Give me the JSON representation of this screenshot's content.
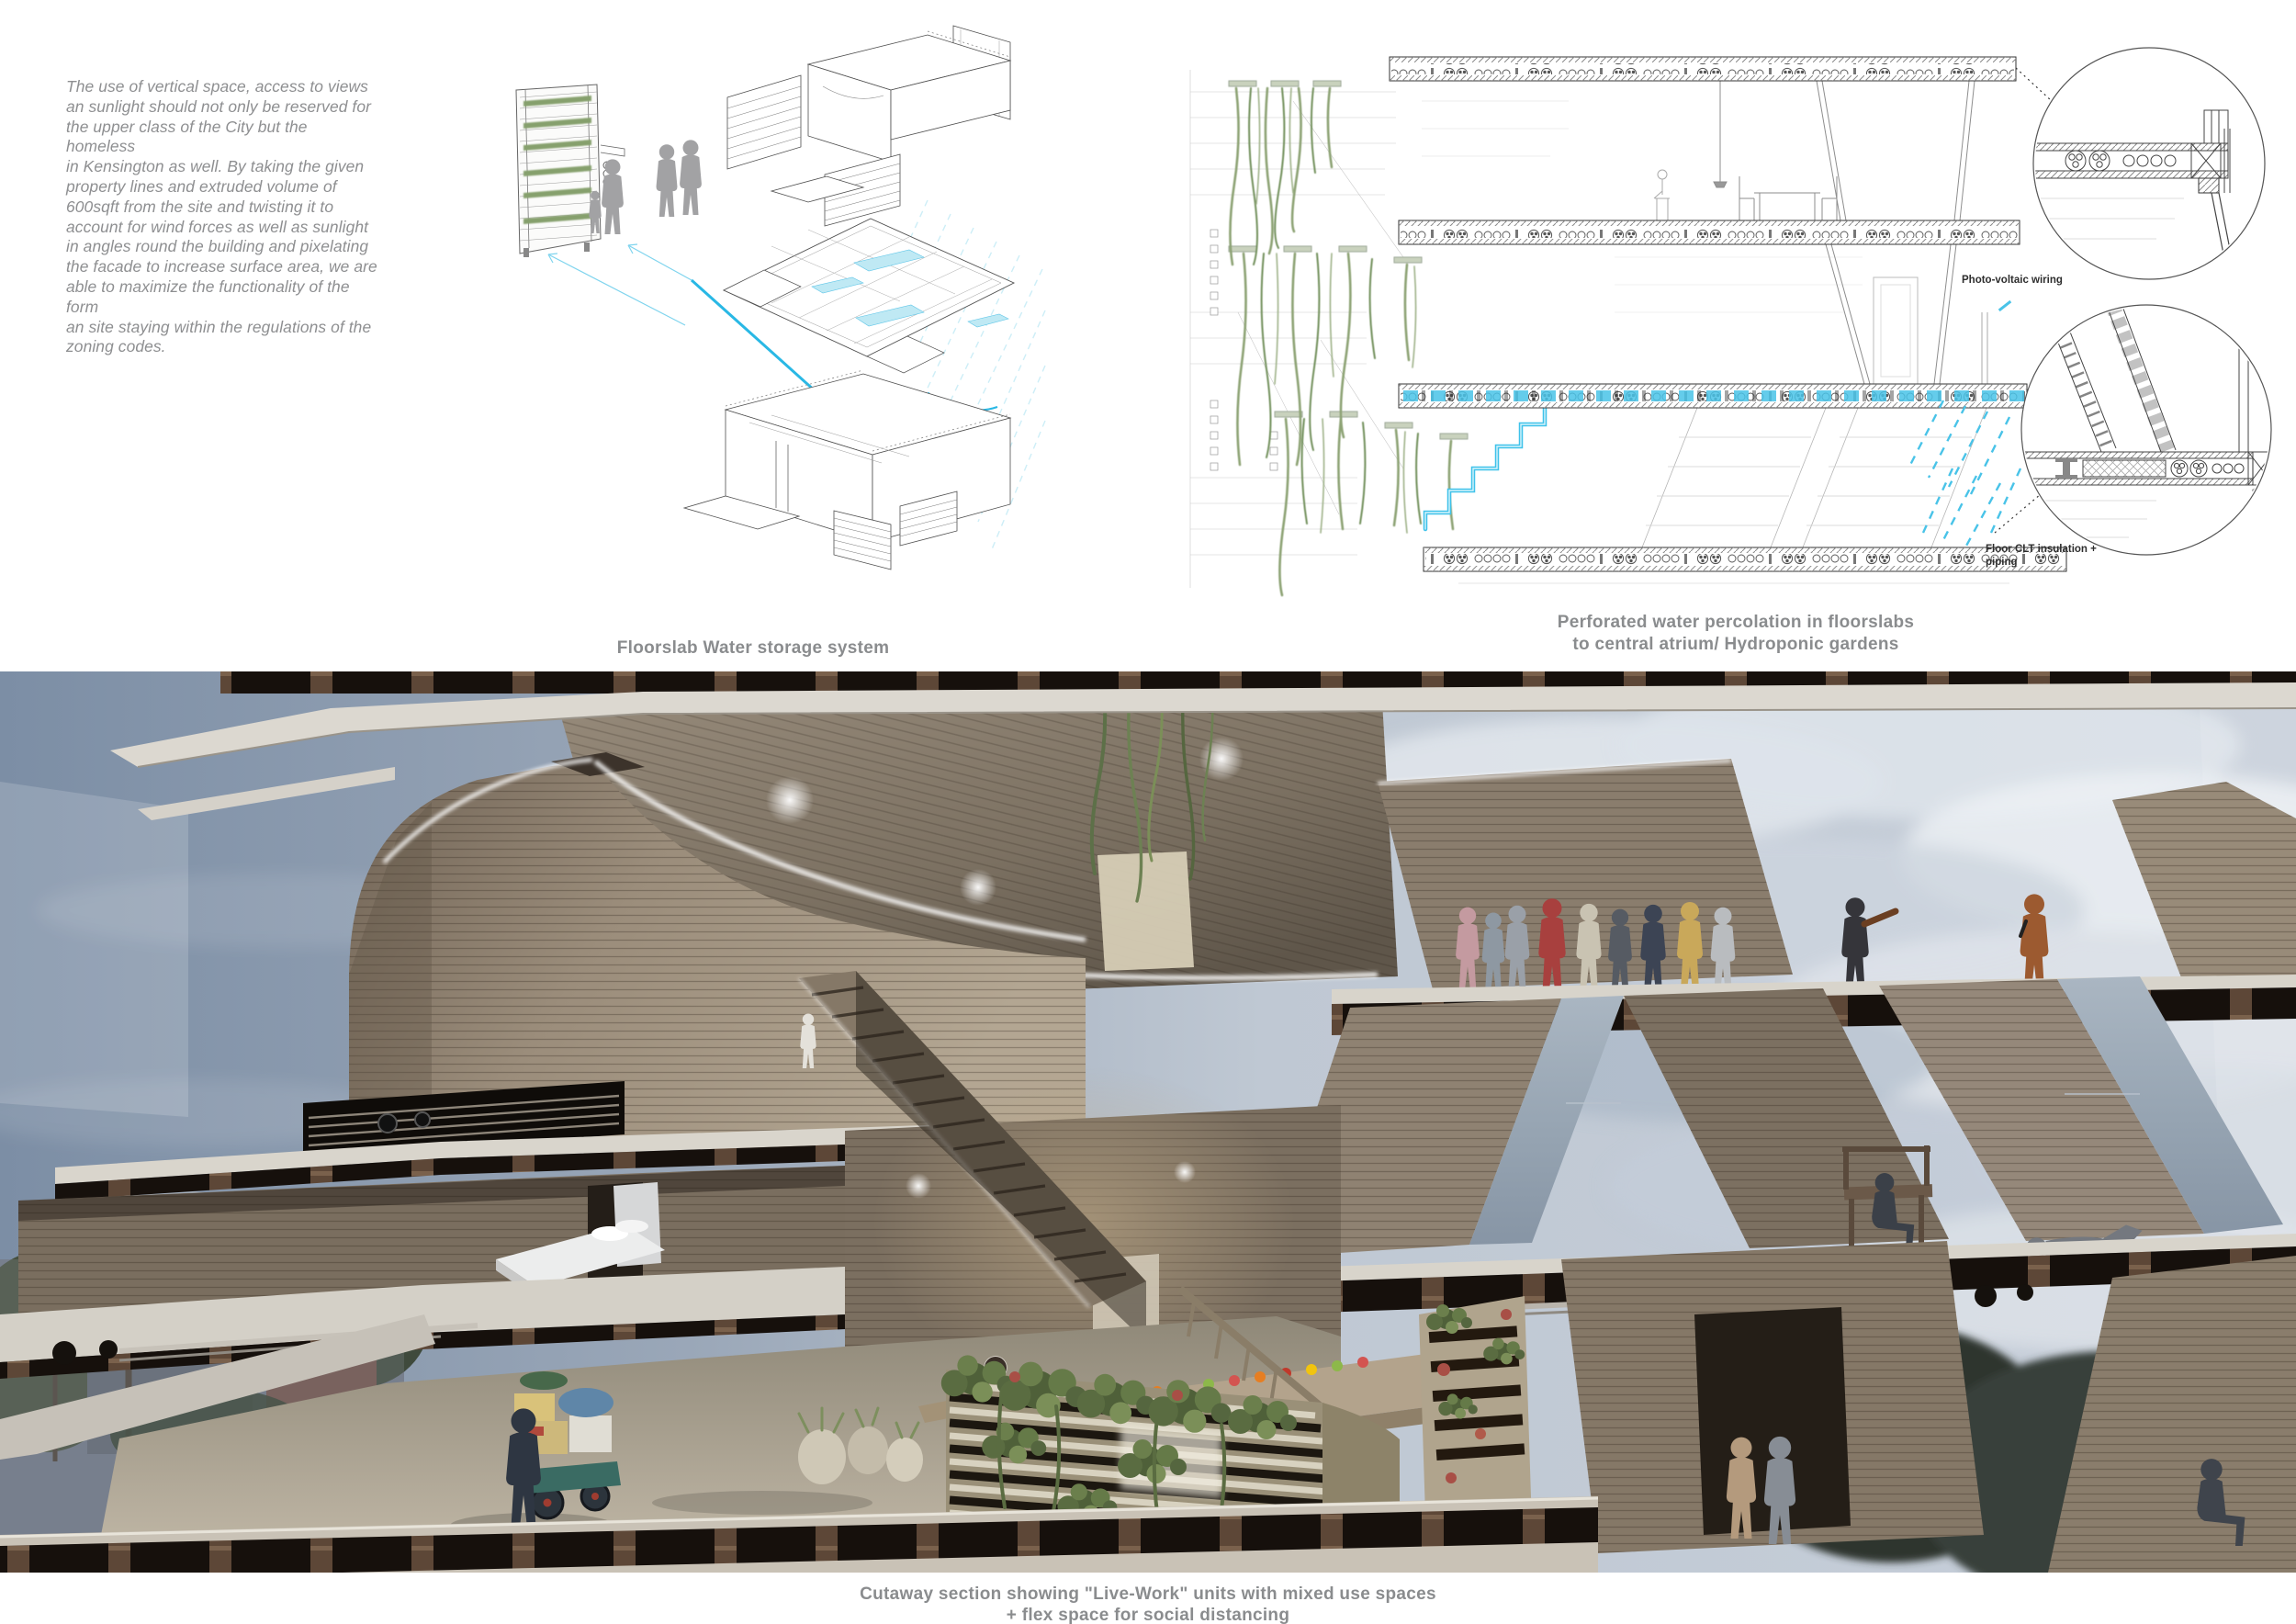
{
  "board": {
    "intro_text": "The use of vertical space, access to views\nan sunlight should not only be reserved for\nthe upper class of the City but the homeless\nin Kensington as well. By taking the given\nproperty lines and extruded volume of\n600sqft from the site and twisting it to\naccount for wind forces as well as sunlight\nin angles round the building and pixelating\nthe facade to increase surface area, we are\nable to maximize the functionality of the form\nan site staying within the regulations of the\nzoning codes."
  },
  "axon_diagram": {
    "caption": "Floorslab Water storage system"
  },
  "section_diagram": {
    "caption_line1": "Perforated water percolation in floorslabs",
    "caption_line2": "to central atrium/ Hydroponic gardens",
    "label_photovoltaic": "Photo-voltaic wiring",
    "label_clt": "Floor CLT insulation +\npiping"
  },
  "render": {
    "caption_line1": "Cutaway section showing \"Live-Work\" units with mixed use spaces",
    "caption_line2": "+ flex space for social distancing"
  },
  "colors": {
    "text_gray": "#8e8f91",
    "caption_gray": "#8a8c8e",
    "annotation_dark": "#2e2e2e",
    "water_cyan": "#3fc2ea",
    "water_fill": "#bfe9f4",
    "plant_green": "#84a06c",
    "sky_slate": "#7c8ea5",
    "timber_tan": "#9b8d7b",
    "slab_white": "#dcd8d0"
  }
}
